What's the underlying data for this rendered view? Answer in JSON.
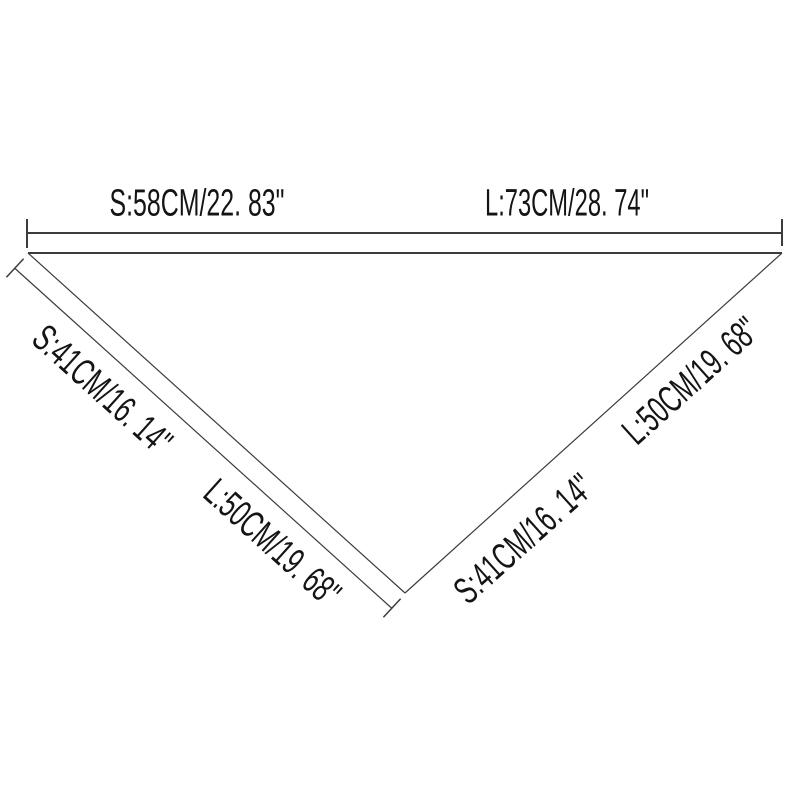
{
  "diagram": {
    "background": "#ffffff",
    "line_color": "#3c3c3c",
    "text_color": "#141414",
    "top_edge": {
      "short_label": "S:58CM/22. 83\"",
      "long_label": "L:73CM/28. 74\""
    },
    "left_edge": {
      "short_label": "S:41CM/16. 14\"",
      "long_label": "L:50CM/19. 68\""
    },
    "right_edge": {
      "short_label": "S:41CM/16. 14\"",
      "long_label": "L:50CM/19. 68\""
    }
  }
}
